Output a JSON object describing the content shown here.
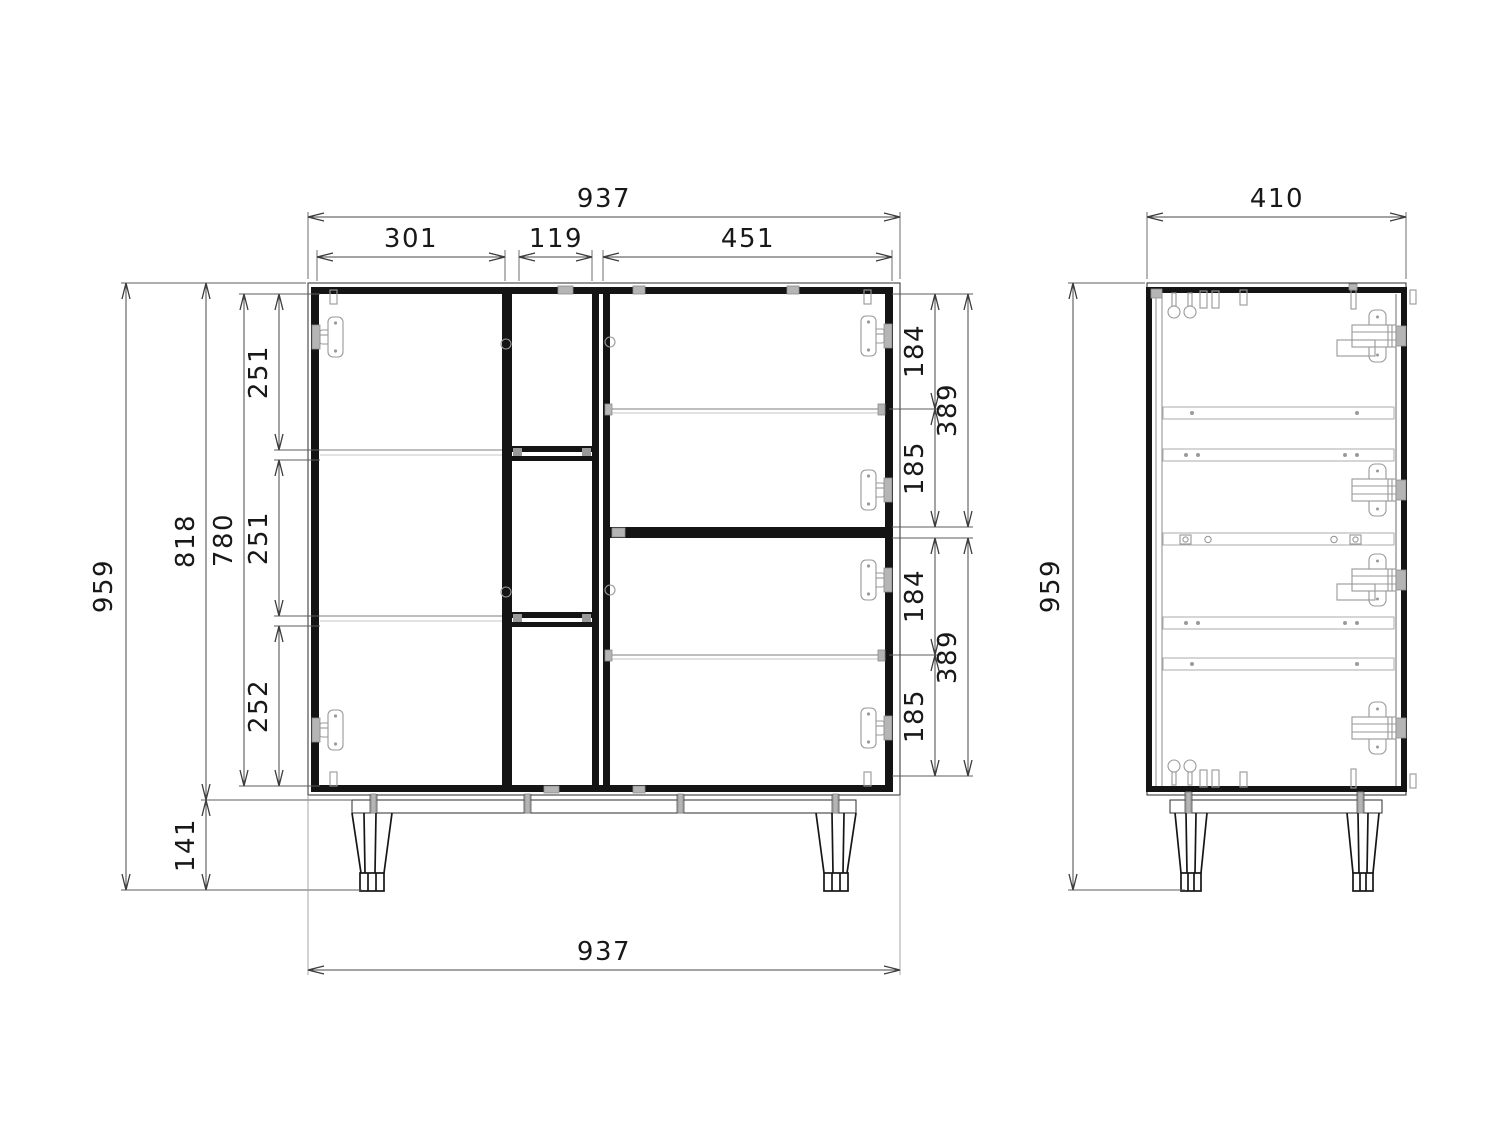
{
  "drawing": {
    "type": "furniture-technical-drawing",
    "units": "mm",
    "background": "#ffffff",
    "line_color": "#2b2b2b",
    "hardware_color": "#b5b5b5"
  },
  "views": {
    "front": {
      "label": "front-view",
      "dims": {
        "top_width": "937",
        "top_left_width": "301",
        "top_middle_width": "119",
        "top_right_width": "451",
        "total_height": "959",
        "carcass_height": "818",
        "interior_height": "780",
        "left_compartment_1": "251",
        "left_compartment_2": "251",
        "left_compartment_3": "252",
        "leg_height": "141",
        "bottom_width": "937",
        "right_upper_above_shelf": "184",
        "right_upper_opening": "389",
        "right_upper_below_shelf": "185",
        "right_lower_above_shelf": "184",
        "right_lower_opening": "389",
        "right_lower_below_shelf": "185"
      }
    },
    "side": {
      "label": "side-view",
      "dims": {
        "depth": "410",
        "total_height": "959"
      }
    }
  }
}
